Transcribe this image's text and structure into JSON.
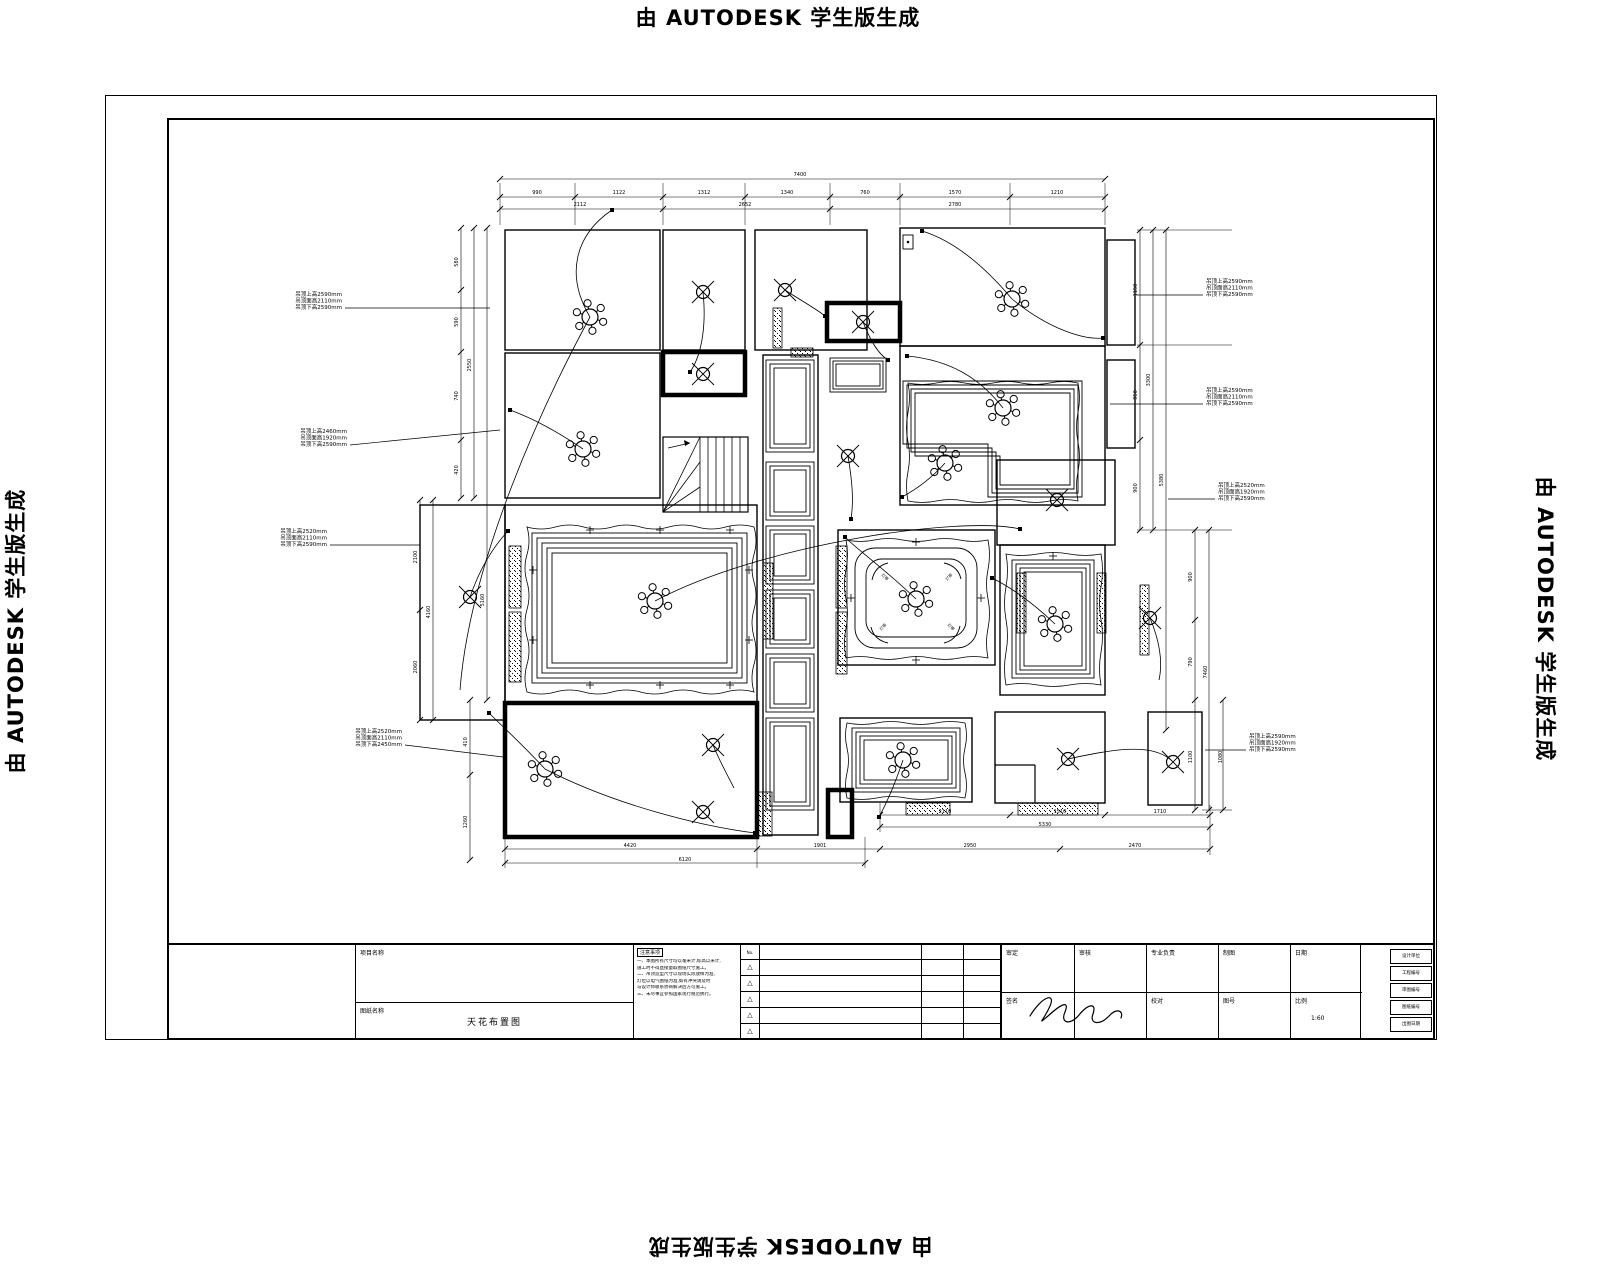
{
  "watermark": {
    "text": "由 AUTODESK 学生版生成"
  },
  "title_block": {
    "project_label": "项目名称",
    "drawing_label": "图纸名称",
    "drawing_name": "天花布置图",
    "notes_title": "注意事项",
    "notes_lines": [
      "一、本图所有尺寸均以毫米计,标高以米计,",
      "施工时不得直接量取图纸尺寸施工。",
      "二、吊顶造型尺寸以现场实际放样为准,",
      "灯位以电气图纸为准,如有冲突请及时",
      "与设计师联系协商解决后方可施工。",
      "三、未尽事宜参照国家现行规范执行。"
    ],
    "rev_no_label": "No.",
    "rev_triangle": "△",
    "sign_row1": [
      "审定",
      "审核",
      "专业负责",
      "制图",
      "日期"
    ],
    "sign_row2_1": "签名",
    "sign_row2_3": "校对",
    "sign_row2_4": "图号",
    "sign_row2_5": "比例",
    "scale_value": "1:60",
    "right_stack": [
      "设计单位",
      "工程编号",
      "审图编号",
      "图纸编号",
      "出图日期"
    ]
  },
  "plan": {
    "rooms": [
      [
        505,
        230,
        155,
        120
      ],
      [
        663,
        230,
        82,
        120
      ],
      [
        755,
        230,
        112,
        120
      ],
      [
        900,
        228,
        205,
        118
      ],
      [
        505,
        353,
        155,
        145
      ],
      [
        763,
        355,
        55,
        480
      ],
      [
        900,
        346,
        205,
        159
      ],
      [
        997,
        460,
        118,
        85
      ],
      [
        420,
        505,
        85,
        215
      ],
      [
        505,
        505,
        252,
        197
      ],
      [
        838,
        530,
        157,
        135
      ],
      [
        1000,
        545,
        105,
        150
      ],
      [
        840,
        718,
        132,
        84
      ],
      [
        995,
        712,
        110,
        91
      ],
      [
        1148,
        712,
        54,
        93
      ],
      [
        1107,
        240,
        28,
        105
      ],
      [
        1107,
        360,
        28,
        88
      ]
    ],
    "thick_rects": [
      [
        827,
        303,
        73,
        38
      ],
      [
        663,
        352,
        82,
        43
      ],
      [
        505,
        703,
        252,
        134
      ],
      [
        828,
        790,
        24,
        47
      ]
    ],
    "hatches": [
      [
        509,
        546,
        12,
        62
      ],
      [
        509,
        612,
        12,
        70
      ],
      [
        763,
        563,
        10,
        76
      ],
      [
        836,
        546,
        11,
        62
      ],
      [
        836,
        612,
        11,
        62
      ],
      [
        773,
        308,
        9,
        40
      ],
      [
        791,
        348,
        22,
        9
      ],
      [
        1017,
        573,
        9,
        60
      ],
      [
        1097,
        573,
        9,
        60
      ],
      [
        906,
        803,
        44,
        12
      ],
      [
        1018,
        803,
        80,
        12
      ],
      [
        758,
        792,
        14,
        44
      ],
      [
        1140,
        585,
        9,
        70
      ]
    ],
    "coffers": [
      [
        766,
        360,
        48,
        92,
        3,
        4
      ],
      [
        766,
        462,
        48,
        58,
        3,
        4
      ],
      [
        766,
        526,
        48,
        58,
        3,
        4
      ],
      [
        766,
        590,
        48,
        58,
        3,
        4
      ],
      [
        766,
        654,
        48,
        58,
        3,
        4
      ],
      [
        766,
        718,
        48,
        92,
        3,
        4
      ],
      [
        830,
        358,
        56,
        34,
        3,
        3
      ],
      [
        532,
        533,
        215,
        150,
        5,
        5
      ],
      [
        1012,
        560,
        82,
        118,
        4,
        4
      ],
      [
        852,
        728,
        108,
        64,
        4,
        4
      ]
    ],
    "l_paths": [
      "M903,381 H1082 V497 H988 V444 H903 Z",
      "M907,385 H1078 V493 H992 V448 H907 Z",
      "M911,389 H1074 V489 H996 V452 H911 Z",
      "M915,393 H1070 V485 H1000 V456 H915 Z"
    ],
    "rounded": {
      "outer": [
        855,
        548,
        122,
        100,
        20
      ],
      "inner": [
        866,
        559,
        100,
        78,
        16
      ],
      "brackets": [
        "M872,580 q3,-14 16,-17",
        "M944,563 q14,3 17,16",
        "M960,626 q-3,14 -16,17",
        "M888,643 q-14,-3 -17,-16"
      ],
      "corner_labels": [
        {
          "x": 884,
          "y": 578,
          "t": "灯带",
          "r": 45
        },
        {
          "x": 950,
          "y": 578,
          "t": "灯带",
          "r": -45
        },
        {
          "x": 950,
          "y": 628,
          "t": "灯带",
          "r": 45
        },
        {
          "x": 884,
          "y": 628,
          "t": "灯带",
          "r": -45
        }
      ]
    },
    "wavy": [
      {
        "x": 527,
        "y": 527,
        "w": 227,
        "h": 165,
        "a": 4
      },
      {
        "x": 846,
        "y": 540,
        "w": 142,
        "h": 118,
        "a": 3
      },
      {
        "x": 908,
        "y": 383,
        "w": 170,
        "h": 118,
        "a": 3
      },
      {
        "x": 1006,
        "y": 554,
        "w": 95,
        "h": 131,
        "a": 3
      },
      {
        "x": 847,
        "y": 723,
        "w": 118,
        "h": 75,
        "a": 3
      }
    ],
    "chandeliers": [
      [
        590,
        317
      ],
      [
        583,
        449
      ],
      [
        1012,
        299
      ],
      [
        1003,
        408
      ],
      [
        945,
        463
      ],
      [
        655,
        601
      ],
      [
        916,
        599
      ],
      [
        1055,
        624
      ],
      [
        545,
        769
      ],
      [
        903,
        760
      ]
    ],
    "downlights": [
      [
        703,
        292
      ],
      [
        785,
        290
      ],
      [
        863,
        322
      ],
      [
        703,
        374
      ],
      [
        848,
        456
      ],
      [
        470,
        597
      ],
      [
        1057,
        500
      ],
      [
        1150,
        618
      ],
      [
        713,
        745
      ],
      [
        703,
        812
      ],
      [
        1068,
        759
      ],
      [
        1173,
        762
      ]
    ],
    "leaders": [
      "M590,317 C565,275 575,235 612,210",
      "M590,317 C545,400 470,560 460,690",
      "M703,292 C707,330 700,358 690,372",
      "M785,290 C800,300 815,308 825,316",
      "M863,322 C872,345 880,355 888,360",
      "M1012,299 C975,255 945,238 922,231",
      "M1012,299 C1050,330 1085,340 1103,338",
      "M583,449 C558,432 532,418 510,410",
      "M655,601 C760,545 960,515 1020,529",
      "M916,599 C878,563 855,548 845,537",
      "M1003,408 C980,378 950,360 907,356",
      "M945,463 C930,480 915,490 902,497",
      "M1055,624 C1030,600 1008,586 992,578",
      "M545,769 C615,805 700,826 755,833",
      "M545,769 C522,744 502,726 489,713",
      "M903,760 C893,790 885,806 879,817",
      "M1068,759 C1110,750 1150,742 1171,760",
      "M470,597 C480,568 494,546 508,531",
      "M848,456 C852,480 854,500 851,519",
      "M713,745 C720,762 728,776 734,788",
      "M1150,618 C1160,642 1163,662 1159,680"
    ],
    "nodes": [
      [
        612,
        210
      ],
      [
        690,
        372
      ],
      [
        825,
        316
      ],
      [
        888,
        360
      ],
      [
        922,
        231
      ],
      [
        1103,
        338
      ],
      [
        510,
        410
      ],
      [
        1020,
        529
      ],
      [
        845,
        537
      ],
      [
        907,
        356
      ],
      [
        902,
        497
      ],
      [
        992,
        578
      ],
      [
        755,
        833
      ],
      [
        489,
        713
      ],
      [
        879,
        817
      ],
      [
        508,
        531
      ],
      [
        851,
        519
      ]
    ],
    "plus": [
      [
        590,
        530
      ],
      [
        660,
        530
      ],
      [
        730,
        530
      ],
      [
        533,
        570
      ],
      [
        533,
        640
      ],
      [
        749,
        570
      ],
      [
        749,
        640
      ],
      [
        590,
        685
      ],
      [
        660,
        685
      ],
      [
        730,
        685
      ],
      [
        916,
        542
      ],
      [
        851,
        598
      ],
      [
        981,
        598
      ],
      [
        916,
        660
      ],
      [
        1053,
        556
      ]
    ],
    "small_rects": [
      [
        903,
        235,
        10,
        14
      ]
    ],
    "lines": [
      [
        995,
        765,
        1035,
        765
      ],
      [
        1035,
        765,
        1035,
        803
      ]
    ],
    "stairs": {
      "x": 663,
      "y": 437,
      "w": 85,
      "h": 75
    },
    "annotations": [
      {
        "x": 342,
        "y": 296,
        "anchor": "end",
        "lines": [
          "吊顶上高2590mm",
          "吊顶面高2110mm",
          "吊顶下高2590mm"
        ],
        "leader": [
          345,
          308,
          490,
          308
        ]
      },
      {
        "x": 347,
        "y": 433,
        "anchor": "end",
        "lines": [
          "吊顶上高2460mm",
          "吊顶面高1920mm",
          "吊顶下高2590mm"
        ],
        "leader": [
          350,
          445,
          500,
          430
        ]
      },
      {
        "x": 327,
        "y": 533,
        "anchor": "end",
        "lines": [
          "吊顶上高2520mm",
          "吊顶面高2110mm",
          "吊顶下高2590mm"
        ],
        "leader": [
          330,
          545,
          420,
          545
        ]
      },
      {
        "x": 402,
        "y": 733,
        "anchor": "end",
        "lines": [
          "吊顶上高2520mm",
          "吊顶面高2110mm",
          "吊顶下高2450mm"
        ],
        "leader": [
          405,
          745,
          503,
          757
        ]
      },
      {
        "x": 1206,
        "y": 283,
        "anchor": "start",
        "lines": [
          "吊顶上高2590mm",
          "吊顶面高2110mm",
          "吊顶下高2590mm"
        ],
        "leader": [
          1203,
          295,
          1137,
          295
        ]
      },
      {
        "x": 1206,
        "y": 392,
        "anchor": "start",
        "lines": [
          "吊顶上高2590mm",
          "吊顶面高2110mm",
          "吊顶下高2590mm"
        ],
        "leader": [
          1203,
          404,
          1110,
          404
        ]
      },
      {
        "x": 1218,
        "y": 487,
        "anchor": "start",
        "lines": [
          "吊顶上高2520mm",
          "吊顶面高1920mm",
          "吊顶下高2590mm"
        ],
        "leader": [
          1215,
          499,
          1168,
          499
        ]
      },
      {
        "x": 1249,
        "y": 738,
        "anchor": "start",
        "lines": [
          "吊顶上高2590mm",
          "吊顶面高1920mm",
          "吊顶下高2590mm"
        ],
        "leader": [
          1246,
          750,
          1205,
          750
        ]
      }
    ],
    "dim_lines_h": [
      {
        "y": 179,
        "f": 500,
        "t": 1105,
        "k": [
          500,
          1105
        ]
      },
      {
        "y": 197,
        "f": 500,
        "t": 1105,
        "k": [
          500,
          575,
          663,
          745,
          830,
          900,
          1010,
          1105
        ]
      },
      {
        "y": 209,
        "f": 500,
        "t": 1105,
        "k": [
          500,
          663,
          830,
          1105
        ]
      },
      {
        "y": 849,
        "f": 505,
        "t": 1210,
        "k": [
          505,
          757,
          880,
          1060,
          1210
        ]
      },
      {
        "y": 863,
        "f": 505,
        "t": 865,
        "k": [
          505,
          865
        ]
      },
      {
        "y": 815,
        "f": 880,
        "t": 1210,
        "k": [
          880,
          1010,
          1105,
          1210
        ]
      },
      {
        "y": 827,
        "f": 880,
        "t": 1210,
        "k": [
          880,
          1210
        ]
      }
    ],
    "dim_lines_v": [
      {
        "x": 461,
        "f": 228,
        "t": 498,
        "k": [
          228,
          290,
          352,
          440,
          498
        ]
      },
      {
        "x": 474,
        "f": 228,
        "t": 498,
        "k": [
          228,
          498
        ]
      },
      {
        "x": 487,
        "f": 228,
        "t": 700,
        "k": [
          228,
          700
        ]
      },
      {
        "x": 420,
        "f": 500,
        "t": 720,
        "k": [
          500,
          610,
          720
        ]
      },
      {
        "x": 433,
        "f": 500,
        "t": 720,
        "k": [
          500,
          720
        ]
      },
      {
        "x": 470,
        "f": 700,
        "t": 860,
        "k": [
          700,
          775,
          860
        ]
      },
      {
        "x": 1140,
        "f": 230,
        "t": 530,
        "k": [
          230,
          345,
          440,
          530
        ]
      },
      {
        "x": 1153,
        "f": 230,
        "t": 530,
        "k": [
          230,
          530
        ]
      },
      {
        "x": 1166,
        "f": 230,
        "t": 730,
        "k": [
          230,
          730
        ]
      },
      {
        "x": 1195,
        "f": 530,
        "t": 810,
        "k": [
          530,
          620,
          700,
          810
        ]
      },
      {
        "x": 1209,
        "f": 530,
        "t": 810,
        "k": [
          530,
          810
        ]
      },
      {
        "x": 1223,
        "f": 700,
        "t": 810,
        "k": [
          700,
          810
        ]
      }
    ],
    "ext_lines": [
      [
        500,
        183,
        500,
        225
      ],
      [
        575,
        183,
        575,
        225
      ],
      [
        663,
        183,
        663,
        225
      ],
      [
        745,
        183,
        745,
        225
      ],
      [
        830,
        183,
        830,
        225
      ],
      [
        900,
        183,
        900,
        225
      ],
      [
        1010,
        183,
        1010,
        225
      ],
      [
        1105,
        183,
        1105,
        225
      ],
      [
        1137,
        230,
        1232,
        230
      ],
      [
        1137,
        345,
        1232,
        345
      ],
      [
        1137,
        530,
        1232,
        530
      ],
      [
        1202,
        810,
        1232,
        810
      ],
      [
        505,
        837,
        505,
        868
      ],
      [
        757,
        837,
        757,
        868
      ],
      [
        865,
        837,
        865,
        868
      ],
      [
        880,
        803,
        880,
        832
      ],
      [
        1210,
        805,
        1210,
        855
      ]
    ],
    "dim_labels": [
      {
        "x": 800,
        "y": 176,
        "t": "7400"
      },
      {
        "x": 537,
        "y": 194,
        "t": "990"
      },
      {
        "x": 619,
        "y": 194,
        "t": "1122"
      },
      {
        "x": 704,
        "y": 194,
        "t": "1312"
      },
      {
        "x": 787,
        "y": 194,
        "t": "1340"
      },
      {
        "x": 865,
        "y": 194,
        "t": "760"
      },
      {
        "x": 955,
        "y": 194,
        "t": "1570"
      },
      {
        "x": 1057,
        "y": 194,
        "t": "1210"
      },
      {
        "x": 580,
        "y": 206,
        "t": "2112"
      },
      {
        "x": 745,
        "y": 206,
        "t": "2652"
      },
      {
        "x": 955,
        "y": 206,
        "t": "2780"
      },
      {
        "x": 458,
        "y": 262,
        "t": "580",
        "r": -90
      },
      {
        "x": 458,
        "y": 322,
        "t": "590",
        "r": -90
      },
      {
        "x": 458,
        "y": 396,
        "t": "740",
        "r": -90
      },
      {
        "x": 458,
        "y": 470,
        "t": "420",
        "r": -90
      },
      {
        "x": 471,
        "y": 365,
        "t": "2550",
        "r": -90
      },
      {
        "x": 484,
        "y": 600,
        "t": "5160",
        "r": -90
      },
      {
        "x": 417,
        "y": 557,
        "t": "2100",
        "r": -90
      },
      {
        "x": 417,
        "y": 667,
        "t": "2060",
        "r": -90
      },
      {
        "x": 430,
        "y": 612,
        "t": "4160",
        "r": -90
      },
      {
        "x": 467,
        "y": 742,
        "t": "410",
        "r": -90
      },
      {
        "x": 467,
        "y": 822,
        "t": "1260",
        "r": -90
      },
      {
        "x": 1137,
        "y": 290,
        "t": "1150",
        "r": -90
      },
      {
        "x": 1137,
        "y": 395,
        "t": "950",
        "r": -90
      },
      {
        "x": 1137,
        "y": 488,
        "t": "900",
        "r": -90
      },
      {
        "x": 1150,
        "y": 380,
        "t": "3300",
        "r": -90
      },
      {
        "x": 1163,
        "y": 480,
        "t": "5380",
        "r": -90
      },
      {
        "x": 1192,
        "y": 577,
        "t": "900",
        "r": -90
      },
      {
        "x": 1192,
        "y": 662,
        "t": "790",
        "r": -90
      },
      {
        "x": 1192,
        "y": 757,
        "t": "1100",
        "r": -90
      },
      {
        "x": 1207,
        "y": 672,
        "t": "7460",
        "r": -90
      },
      {
        "x": 1222,
        "y": 757,
        "t": "1080",
        "r": -90
      },
      {
        "x": 630,
        "y": 847,
        "t": "4420"
      },
      {
        "x": 820,
        "y": 847,
        "t": "1901"
      },
      {
        "x": 970,
        "y": 847,
        "t": "2950"
      },
      {
        "x": 1135,
        "y": 847,
        "t": "2470"
      },
      {
        "x": 685,
        "y": 861,
        "t": "6120"
      },
      {
        "x": 945,
        "y": 813,
        "t": "2110"
      },
      {
        "x": 1060,
        "y": 813,
        "t": "1510"
      },
      {
        "x": 1160,
        "y": 813,
        "t": "1710"
      },
      {
        "x": 1045,
        "y": 826,
        "t": "5330"
      }
    ],
    "signature_path": "M1030,1016 C1042,996 1056,992 1050,1006 C1044,1020 1036,1026 1048,1016 C1060,1005 1070,999 1065,1012 C1060,1023 1070,1026 1079,1015 C1088,1004 1097,1002 1093,1014 C1089,1024 1100,1026 1109,1016 C1116,1008 1124,1010 1121,1018"
  }
}
